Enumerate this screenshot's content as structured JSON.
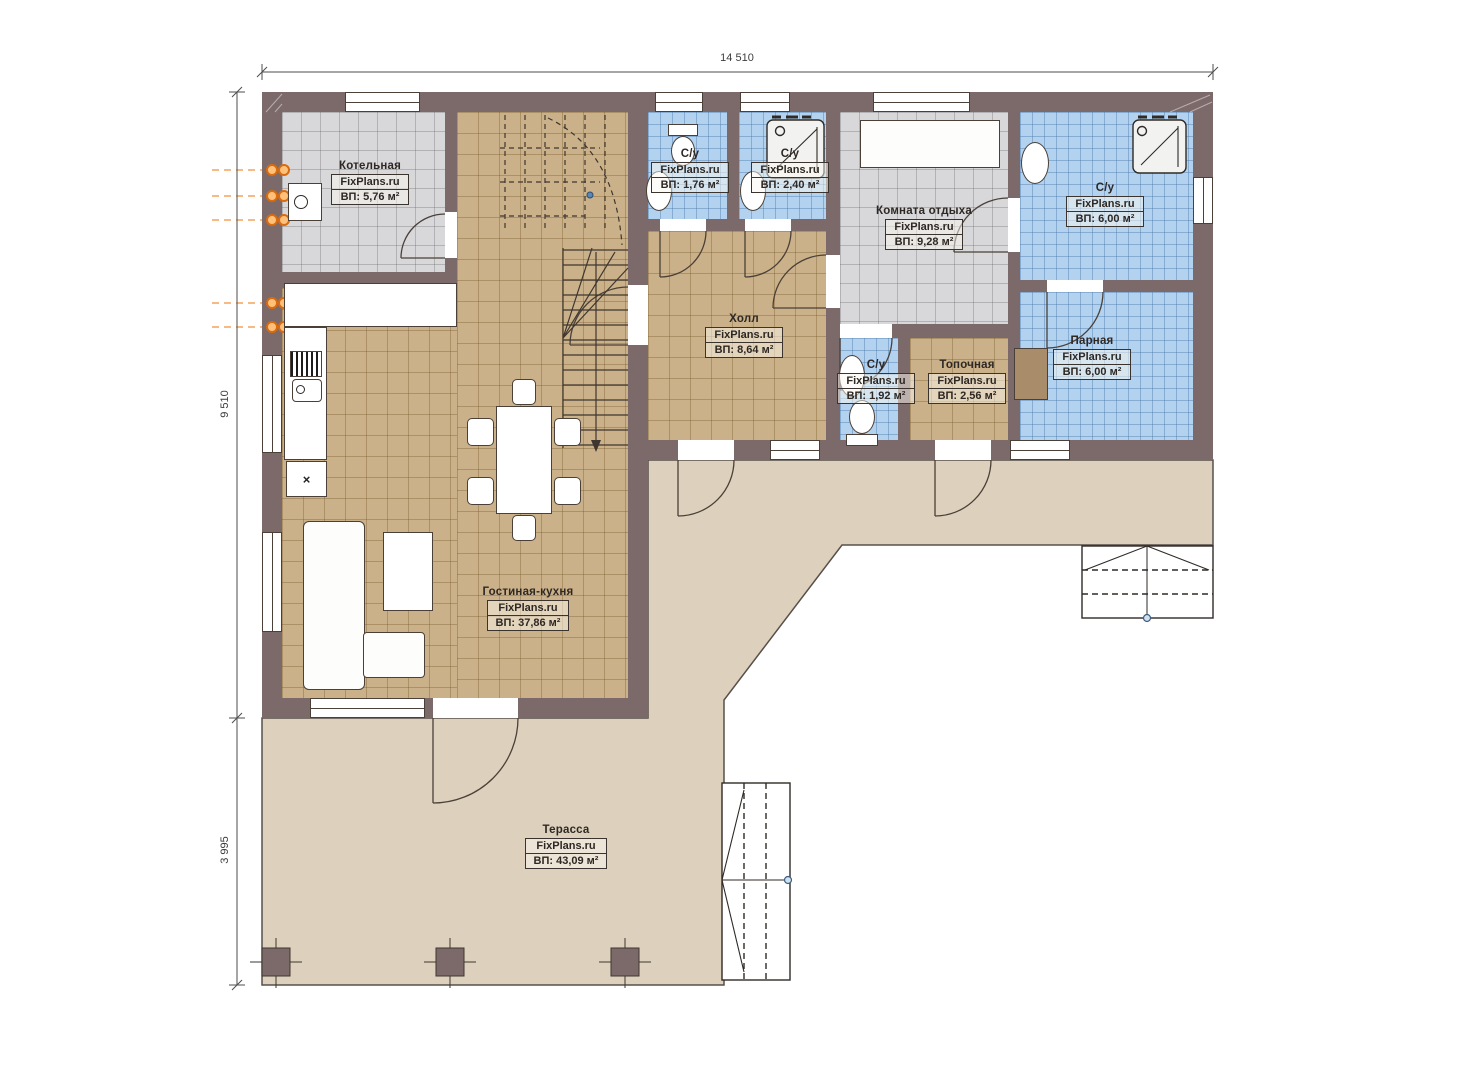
{
  "watermark": "FixPlans.ru",
  "dimensions": {
    "total_width": "14 510",
    "main_height": "9 510",
    "terrace_height": "3 995"
  },
  "rooms": [
    {
      "name": "Котельная",
      "area": "ВП: 5,76 м²"
    },
    {
      "name": "С/у",
      "area": "ВП: 1,76 м²"
    },
    {
      "name": "С/у",
      "area": "ВП: 2,40 м²"
    },
    {
      "name": "Комната отдыха",
      "area": "ВП: 9,28 м²"
    },
    {
      "name": "С/у",
      "area": "ВП: 6,00 м²"
    },
    {
      "name": "Холл",
      "area": "ВП: 8,64 м²"
    },
    {
      "name": "Парная",
      "area": "ВП: 6,00 м²"
    },
    {
      "name": "С/у",
      "area": "ВП: 1,92 м²"
    },
    {
      "name": "Топочная",
      "area": "ВП: 2,56 м²"
    },
    {
      "name": "Гостиная-кухня",
      "area": "ВП: 37,86 м²"
    },
    {
      "name": "Терасса",
      "area": "ВП: 43,09 м²"
    }
  ],
  "marks": {
    "cabinet_mark": "×"
  },
  "colors": {
    "wall": "#7c6a6b",
    "floor_tan": "#cbb189",
    "floor_gray": "#d8d8da",
    "floor_blue": "#b2d2ef",
    "terrace": "#ddd1bd",
    "line": "#4a4038",
    "accent_orange": "#ee7d22",
    "dot_blue": "#5b87b8"
  }
}
